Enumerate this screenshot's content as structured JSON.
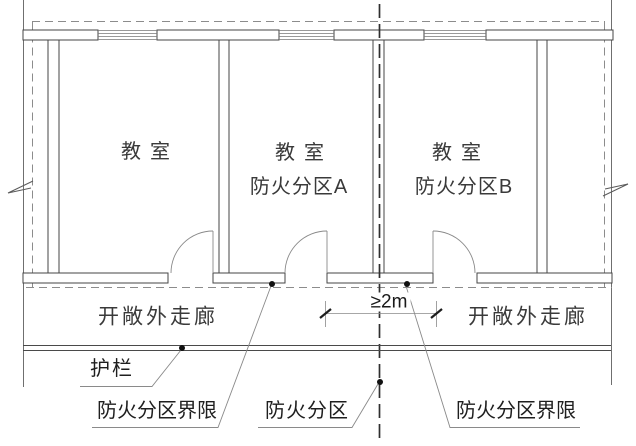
{
  "rooms": [
    {
      "name": "教室",
      "zone": ""
    },
    {
      "name": "教室",
      "zone": "防火分区A"
    },
    {
      "name": "教室",
      "zone": "防火分区B"
    }
  ],
  "corridor": {
    "left_label": "开敞外走廊",
    "right_label": "开敞外走廊"
  },
  "dimension": {
    "min_distance": "≥2m"
  },
  "annotations": {
    "guardrail": "护栏",
    "fire_boundary_left": "防火分区界限",
    "fire_zone": "防火分区",
    "fire_boundary_right": "防火分区界限"
  },
  "colors": {
    "background": "#ffffff",
    "wall_line": "#454545",
    "thin_line": "#7a7a7a",
    "dashed_boundary": "#8c8c8c",
    "centerline": "#2f2f2f",
    "text": "#2e2e2e"
  }
}
